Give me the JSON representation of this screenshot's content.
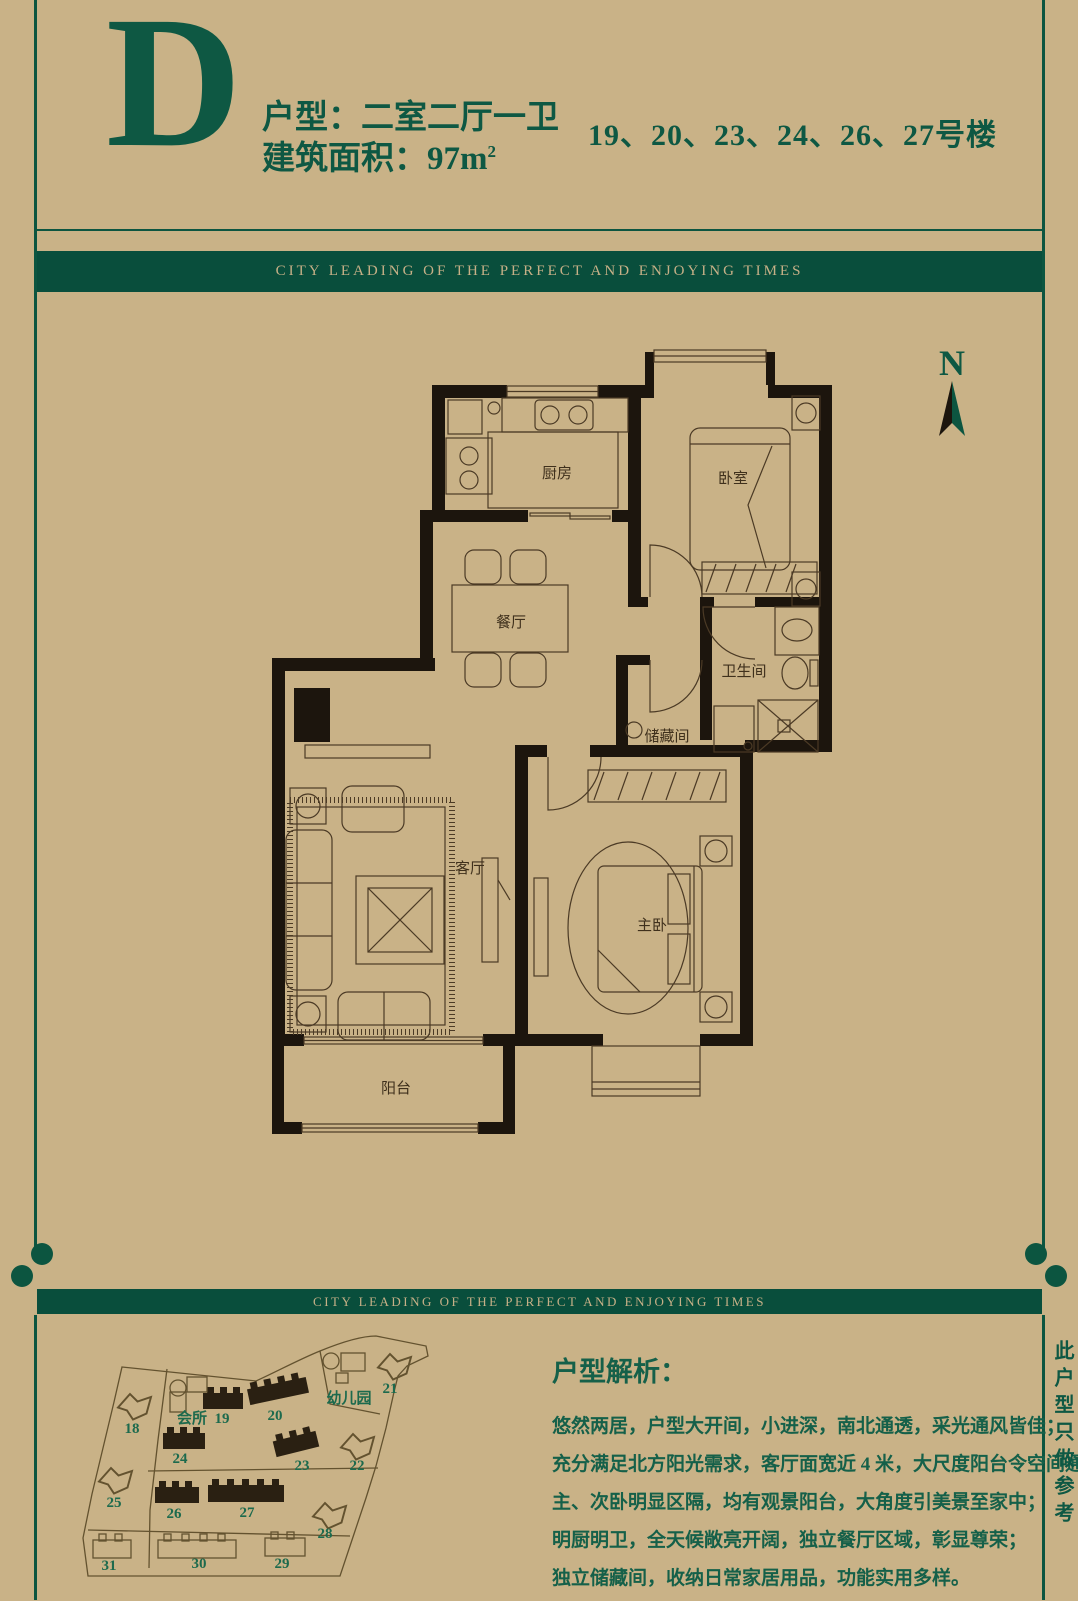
{
  "page": {
    "banner_text": "CITY LEADING OF THE PERFECT AND ENJOYING TIMES",
    "side_note": "此户型只做参考",
    "north_label": "N"
  },
  "header": {
    "type_letter": "D",
    "layout_line": "户型：二室二厅一卫",
    "area_label": "建筑面积：97m",
    "area_sup": "2",
    "buildings": "19、20、23、24、26、27号楼"
  },
  "floor_plan": {
    "rooms": [
      {
        "id": "kitchen",
        "label": "厨房"
      },
      {
        "id": "bedroom",
        "label": "卧室"
      },
      {
        "id": "dining",
        "label": "餐厅"
      },
      {
        "id": "bath",
        "label": "卫生间"
      },
      {
        "id": "storage",
        "label": "储藏间"
      },
      {
        "id": "living",
        "label": "客厅"
      },
      {
        "id": "master",
        "label": "主卧"
      },
      {
        "id": "balcony",
        "label": "阳台"
      }
    ]
  },
  "site_plan": {
    "labels": [
      {
        "text": "18"
      },
      {
        "text": "19"
      },
      {
        "text": "20"
      },
      {
        "text": "21"
      },
      {
        "text": "22"
      },
      {
        "text": "23"
      },
      {
        "text": "24"
      },
      {
        "text": "25"
      },
      {
        "text": "26"
      },
      {
        "text": "27"
      },
      {
        "text": "28"
      },
      {
        "text": "29"
      },
      {
        "text": "30"
      },
      {
        "text": "31"
      },
      {
        "text": "会所"
      },
      {
        "text": "幼儿园"
      }
    ]
  },
  "analysis": {
    "heading": "户型解析：",
    "lines": [
      "悠然两居，户型大开间，小进深，南北通透，采光通风皆佳；",
      "充分满足北方阳光需求，客厅面宽近 4 米，大尺度阳台令空间通透非凡；",
      "主、次卧明显区隔，均有观景阳台，大角度引美景至家中；",
      "明厨明卫，全天候敞亮开阔，独立餐厅区域，彰显尊荣；",
      "独立储藏间，收纳日常家居用品，功能实用多样。"
    ]
  }
}
